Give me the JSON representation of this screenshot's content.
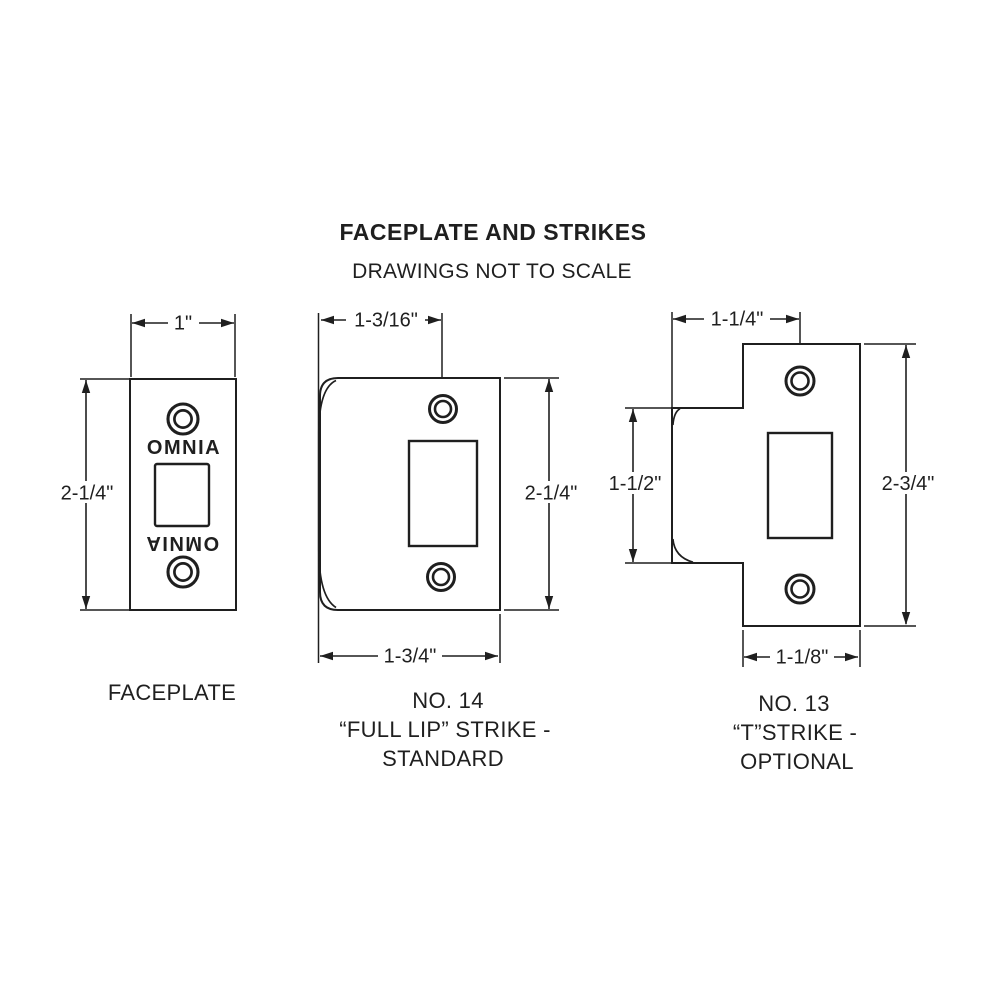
{
  "page": {
    "title": "FACEPLATE AND STRIKES",
    "subtitle": "DRAWINGS NOT TO SCALE"
  },
  "colors": {
    "ink": "#1f1f1f",
    "background": "#ffffff"
  },
  "faceplate": {
    "label": "FACEPLATE",
    "engraving_top": "OMNIA",
    "engraving_bottom": "OMNIA",
    "dims": {
      "width": "1\"",
      "height": "2-1/4\""
    }
  },
  "full_lip_strike": {
    "label_line1": "NO. 14",
    "label_line2": "“FULL LIP” STRIKE -",
    "label_line3": "STANDARD",
    "dims": {
      "top_width": "1-3/16\"",
      "height": "2-1/4\"",
      "bottom_width": "1-3/4\""
    }
  },
  "t_strike": {
    "label_line1": "NO. 13",
    "label_line2": "“T”STRIKE -",
    "label_line3": "OPTIONAL",
    "dims": {
      "top_width": "1-1/4\"",
      "lip_height": "1-1/2\"",
      "height": "2-3/4\"",
      "bottom_width": "1-1/8\""
    }
  }
}
